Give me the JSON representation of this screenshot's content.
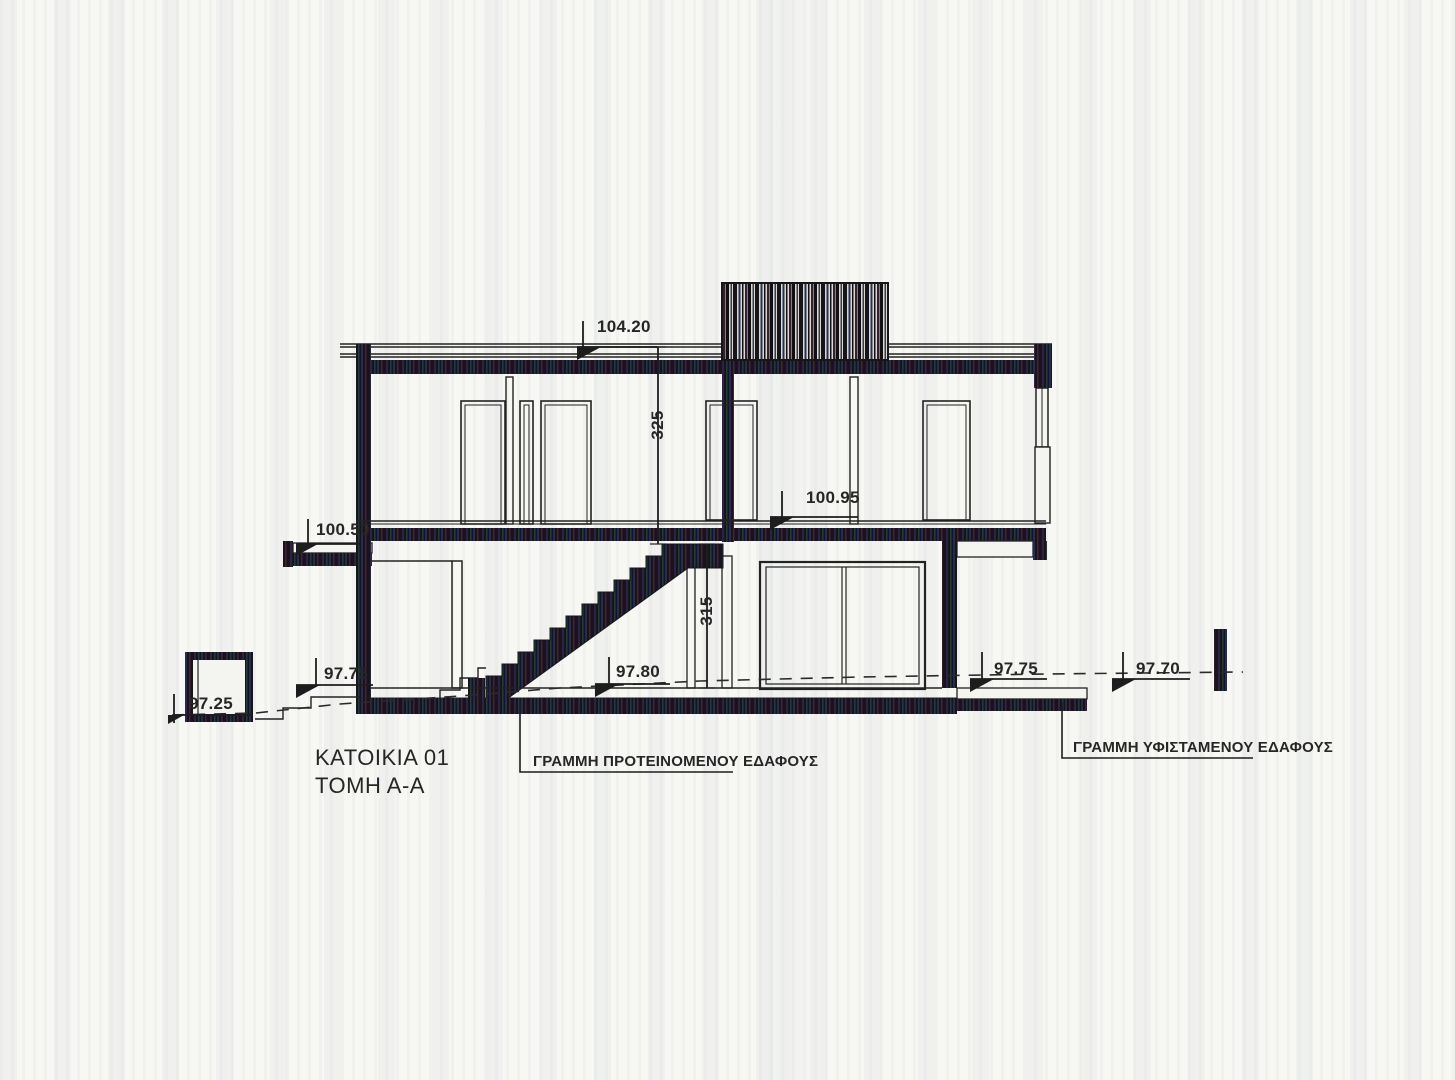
{
  "drawing": {
    "title_line1": "ΚΑΤΟΙΚΙΑ 01",
    "title_line2": "ΤΟΜΗ Α-Α",
    "ground_labels": {
      "proposed": "ΓΡΑΜΜΗ ΠΡΟΤΕΙΝΟΜΕΝΟΥ ΕΔΑΦΟΥΣ",
      "existing": "ΓΡΑΜΜΗ ΥΦΙΣΤΑΜΕΝΟΥ ΕΔΑΦΟΥΣ"
    },
    "elevations": {
      "roof": "104.20",
      "upper_floor": "100.95",
      "balcony_left": "100.50",
      "ground_left": "97.75",
      "ground_interior": "97.80",
      "ground_right_near": "97.75",
      "ground_right_far": "97.70",
      "planter": "97.25"
    },
    "dimensions": {
      "upper_storey_height": "325",
      "lower_storey_height": "315"
    },
    "colors": {
      "ink": "#222222",
      "paper": "#f7f7f3",
      "scan_fill": "#18141c"
    }
  }
}
